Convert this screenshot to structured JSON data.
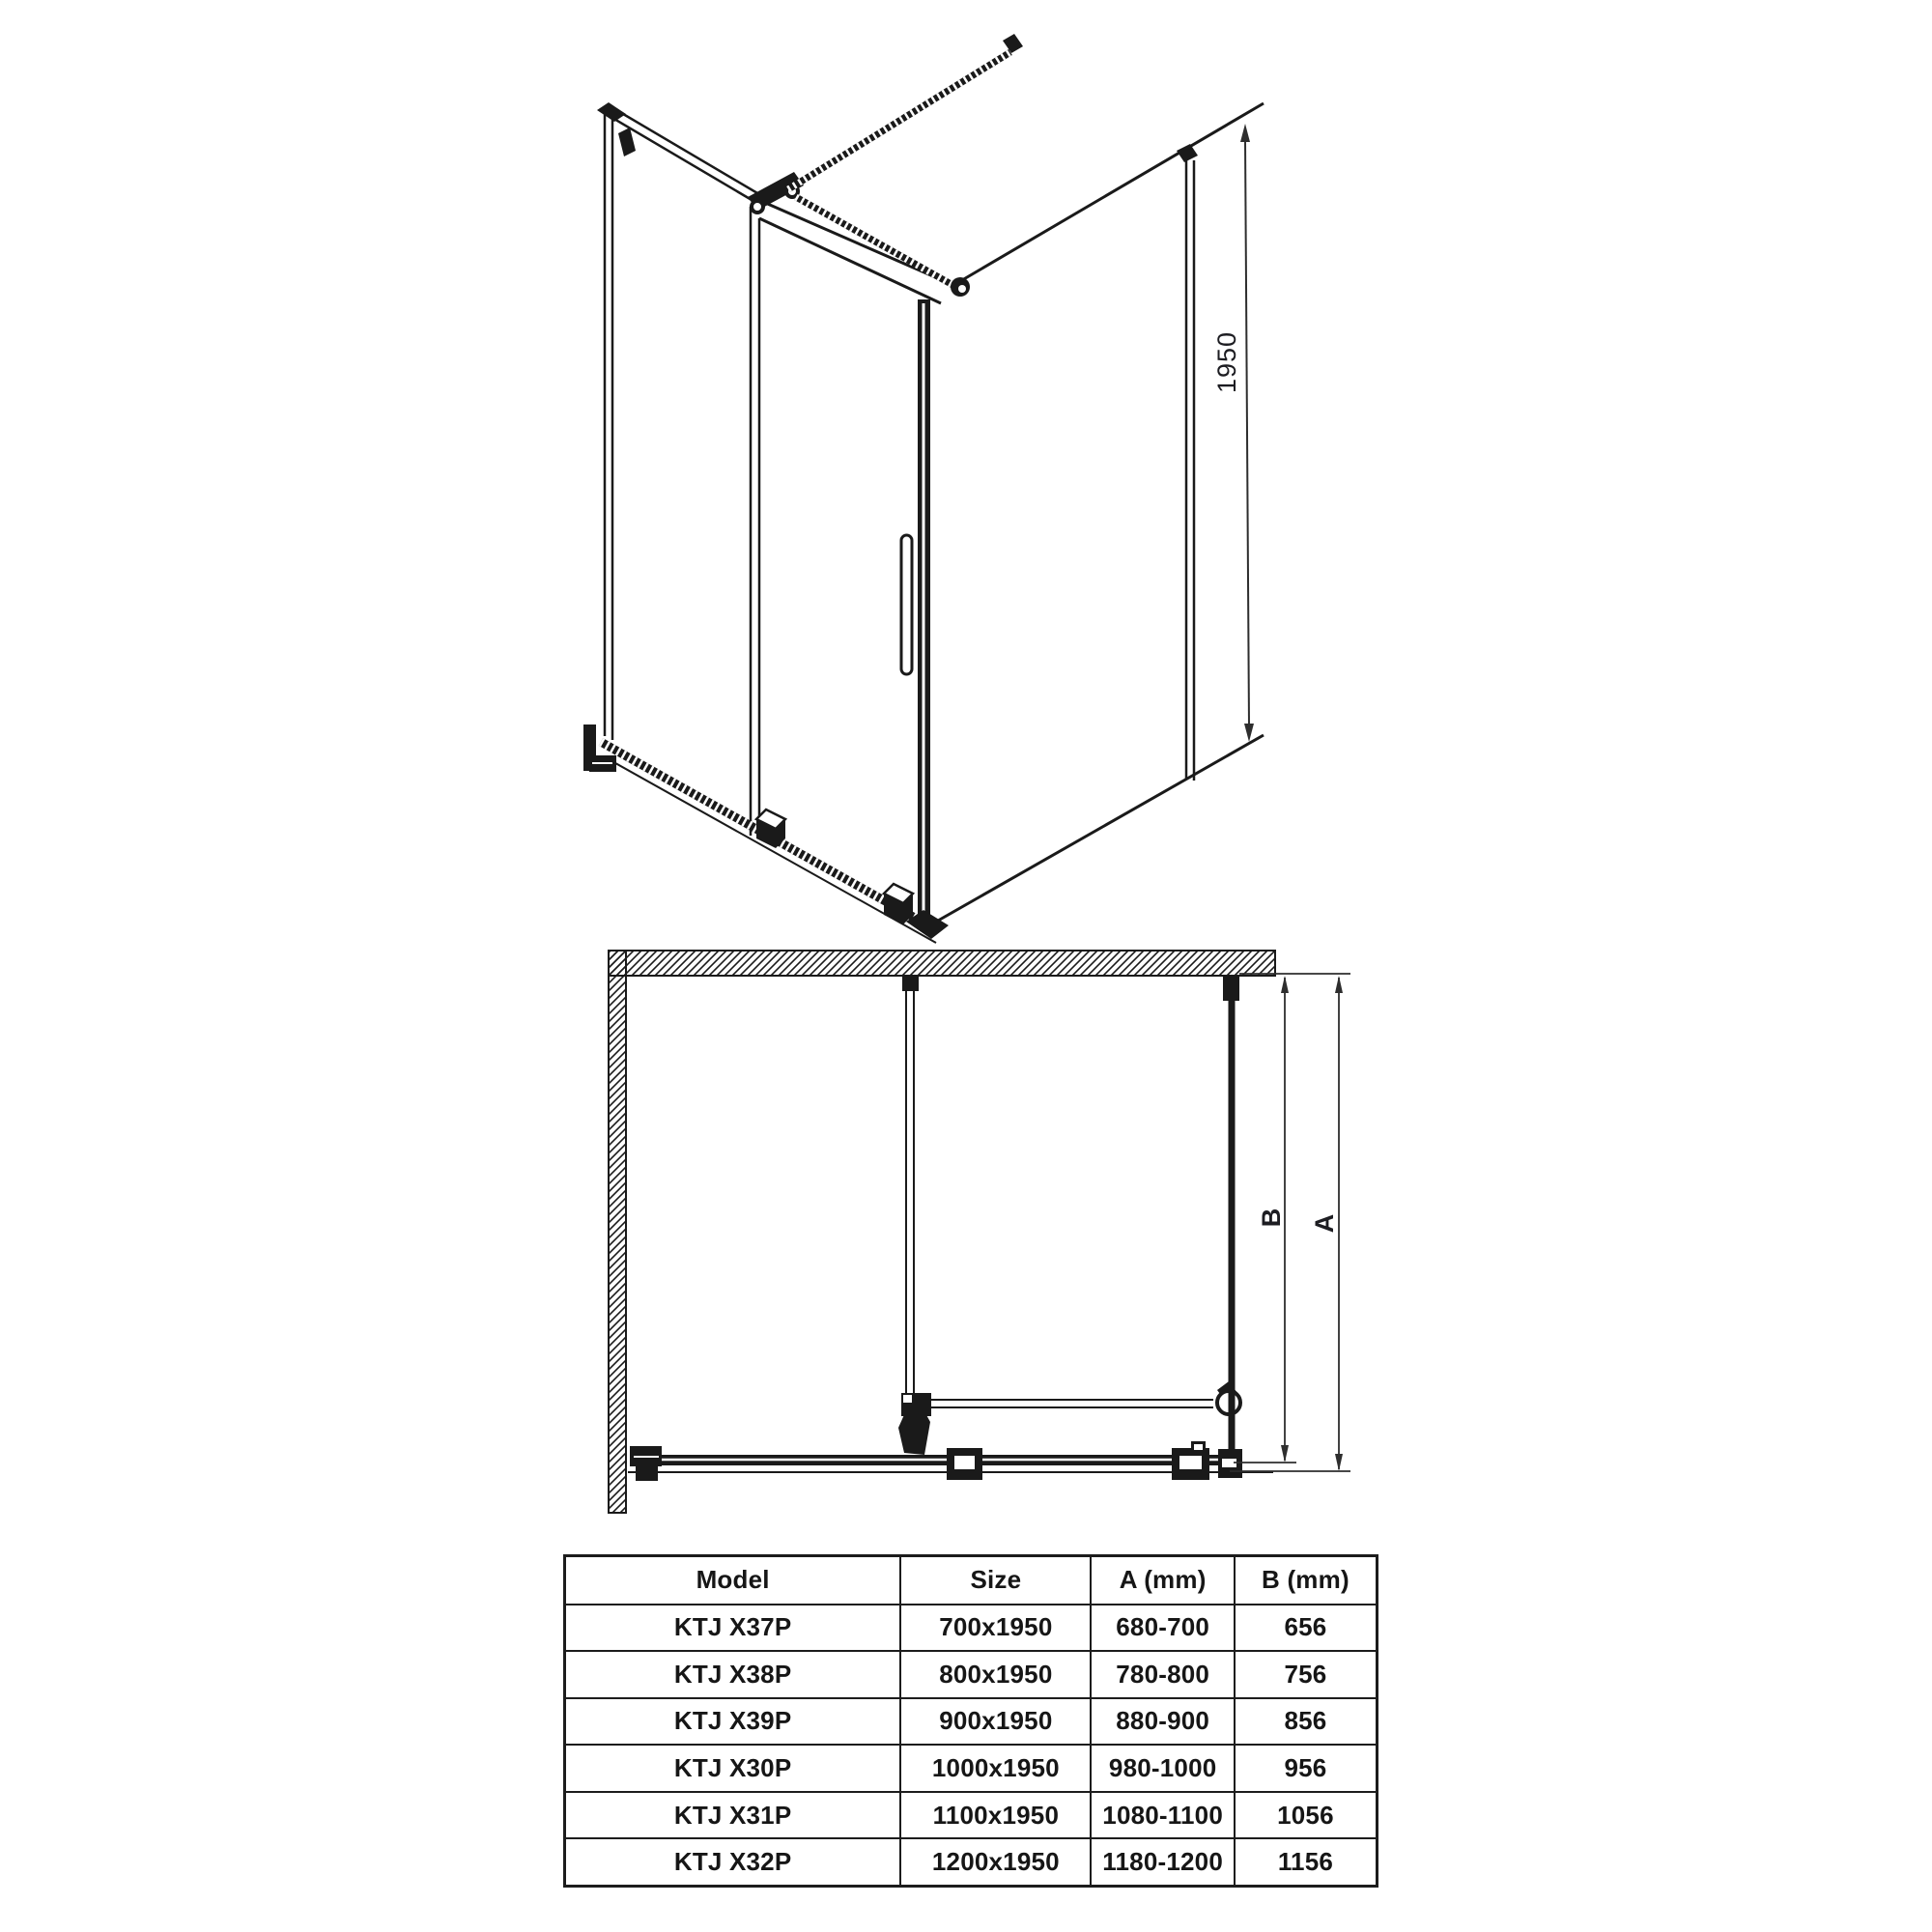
{
  "colors": {
    "ink": "#1a1a1a",
    "dim_line": "#2e2e2e",
    "background": "#ffffff"
  },
  "perspective_view": {
    "description": "3D line drawing of corner shower enclosure with sliding door, side panel and threaded support bars",
    "height_dimension_label": "1950"
  },
  "plan_view": {
    "description": "Top plan view with hatched walls, support bar, stabilizer bar, bottom rail and dimension lines",
    "depth_dimension_label": "B",
    "width_dimension_label": "A"
  },
  "spec_table": {
    "headers": {
      "model": "Model",
      "size": "Size",
      "a": "A (mm)",
      "b": "B (mm)"
    },
    "rows": [
      {
        "model": "KTJ X37P",
        "size": "700x1950",
        "a": "680-700",
        "b": "656"
      },
      {
        "model": "KTJ X38P",
        "size": "800x1950",
        "a": "780-800",
        "b": "756"
      },
      {
        "model": "KTJ X39P",
        "size": "900x1950",
        "a": "880-900",
        "b": "856"
      },
      {
        "model": "KTJ X30P",
        "size": "1000x1950",
        "a": "980-1000",
        "b": "956"
      },
      {
        "model": "KTJ X31P",
        "size": "1100x1950",
        "a": "1080-1100",
        "b": "1056"
      },
      {
        "model": "KTJ X32P",
        "size": "1200x1950",
        "a": "1180-1200",
        "b": "1156"
      }
    ]
  }
}
